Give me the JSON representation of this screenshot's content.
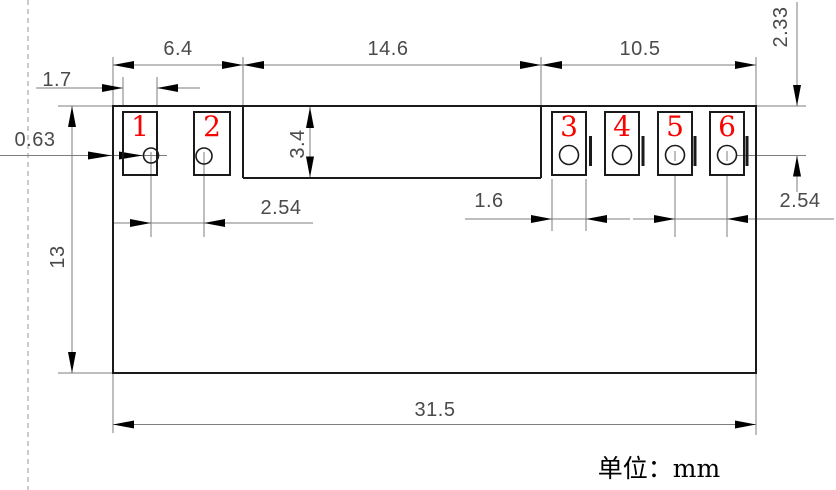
{
  "drawing": {
    "type": "mechanical-dimension-drawing",
    "unit_note": "单位：mm",
    "pad_numbers": [
      "1",
      "2",
      "3",
      "4",
      "5",
      "6"
    ],
    "dimensions": {
      "pads12_group_width": "6.4",
      "center_span": "14.6",
      "pads36_group_width": "10.5",
      "pad1_width": "1.7",
      "edge_to_hole": "0.63",
      "top_to_hole_offset": "2.33",
      "tab_height": "3.4",
      "left_hole_pitch": "2.54",
      "pad3_width": "1.6",
      "right_hole_pitch": "2.54",
      "body_height": "13",
      "overall_width": "31.5"
    },
    "colors": {
      "outline": "#1a1a1a",
      "dimension_lines": "#7d7d7d",
      "dimension_text": "#4a4a4a",
      "arrows": "#000000",
      "pad_number": "#f80400",
      "unit_text": "#000000",
      "border_dash": "#aaaaaa"
    }
  }
}
